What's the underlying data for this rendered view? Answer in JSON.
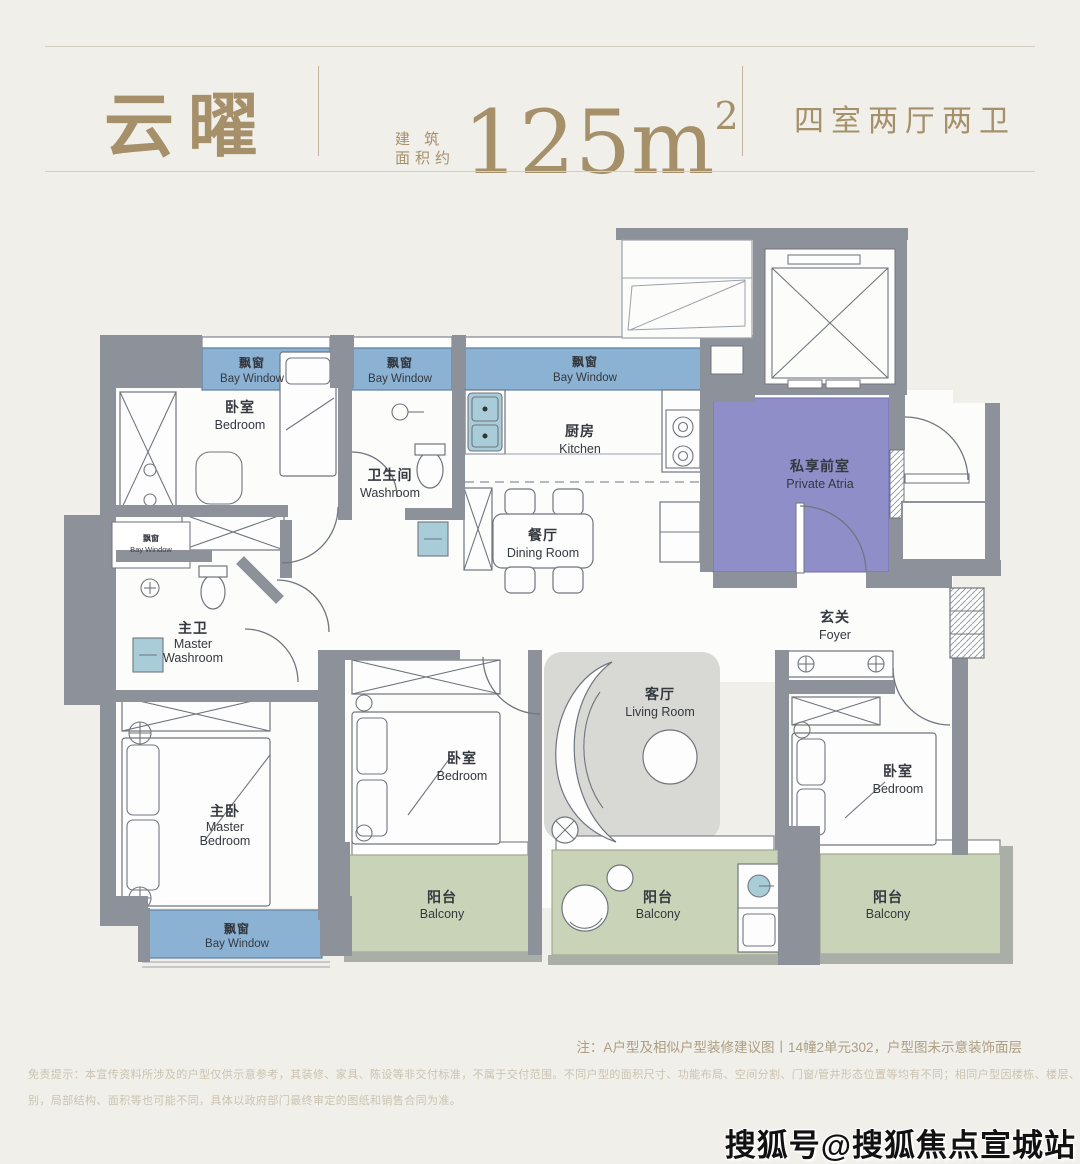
{
  "header": {
    "title": "云曜",
    "area_label_line1": "建 筑",
    "area_label_line2": "面积约",
    "area_value": "125m",
    "area_exponent": "2",
    "spec": "四室两厅两卫",
    "accent_color": "#a5906a"
  },
  "plan": {
    "labels": {
      "bay_window": {
        "zh": "飘窗",
        "en": "Bay Window"
      },
      "bedroom": {
        "zh": "卧室",
        "en": "Bedroom"
      },
      "washroom": {
        "zh": "卫生间",
        "en": "Washroom"
      },
      "kitchen": {
        "zh": "厨房",
        "en": "Kitchen"
      },
      "dining": {
        "zh": "餐厅",
        "en": "Dining Room"
      },
      "private_atria": {
        "zh": "私享前室",
        "en": "Private Atria"
      },
      "foyer": {
        "zh": "玄关",
        "en": "Foyer"
      },
      "master_washroom": {
        "zh": "主卫",
        "en_line1": "Master",
        "en_line2": "Washroom"
      },
      "master_bedroom": {
        "zh": "主卧",
        "en_line1": "Master",
        "en_line2": "Bedroom"
      },
      "living": {
        "zh": "客厅",
        "en": "Living Room"
      },
      "balcony": {
        "zh": "阳台",
        "en": "Balcony"
      }
    },
    "colors": {
      "wall": "#8d9199",
      "bay_window": "#8cb2d3",
      "balcony": "#c9d3b7",
      "atria": "#908ec8",
      "fixture_blue": "#a9ccd9",
      "rug": "#d8d8d5"
    }
  },
  "footer": {
    "note": "注：A户型及相似户型装修建议图丨14幢2单元302，户型图未示意装饰面层",
    "disclaimer_line1": "免责提示：本宣传资料所涉及的户型仅供示意参考，其装修、家具、陈设等非交付标准，不属于交付范围。不同户型的面积尺寸、功能布局、空间分割、门窗/管井形态位置等均有不同；相同户型因楼栋、楼层、单元等差",
    "disclaimer_line2": "别，局部结构、面积等也可能不同，具体以政府部门最终审定的图纸和销售合同为准。"
  },
  "watermark": "搜狐号@搜狐焦点宣城站"
}
